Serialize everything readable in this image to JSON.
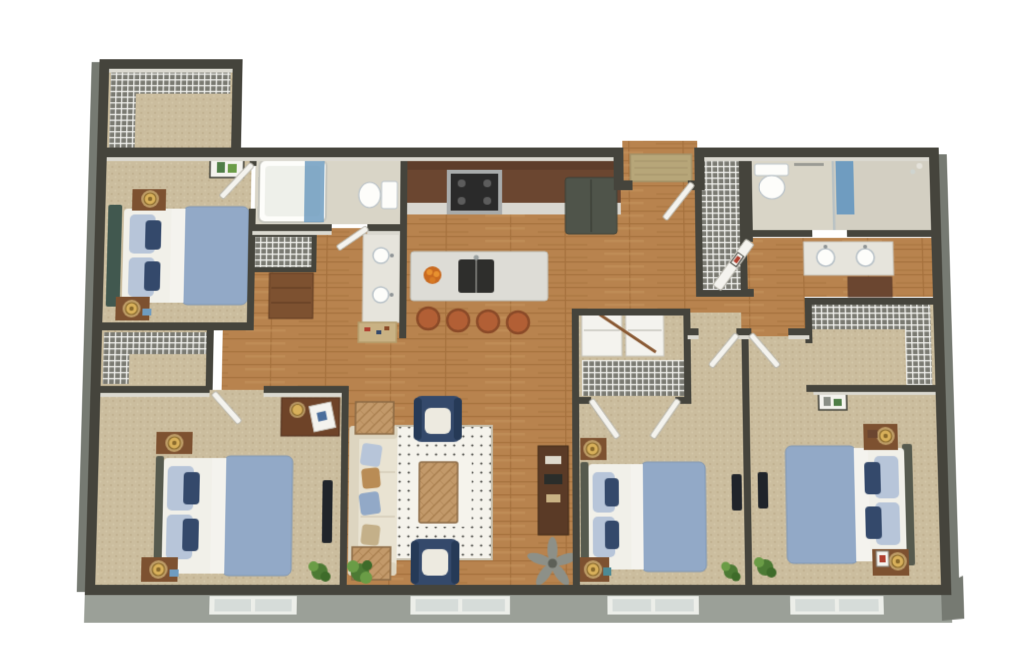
{
  "scene": {
    "label": "3D aerial floor plan rendering of a four-bedroom, two-bathroom apartment with open kitchen and living room",
    "bedrooms": 4,
    "bathrooms": 2,
    "style": "photoreal dollhouse top-down render, no text labels"
  },
  "palette": {
    "bg": "#ffffff",
    "wallTop": "#45443c",
    "wallFace": "#dbd9d0",
    "facade": "#9ba098",
    "facadeDark": "#767a72",
    "wood": "#b8834e",
    "plankLine": "#a5713d",
    "plankLight": "#c9965f",
    "carpet": "#cbbd9e",
    "carpetDotA": "#bcac8a",
    "carpetDotB": "#d6c9ab",
    "bathFloor": "#d9d5c7",
    "wireBase": "#7a7a72",
    "wireLine": "#f2f2ee",
    "white": "#f4f3ee",
    "linen": "#f1f0e9",
    "duvet": "#92a9c7",
    "duvetEdge": "#7e96b4",
    "pillow": "#b7c5d9",
    "navy": "#34496b",
    "headboardTeal": "#41584f",
    "headboardGray": "#565a4e",
    "sofa": "#e9e3d2",
    "sofaArm": "#ddd5c0",
    "rug": "#f5f3ec",
    "rugDot": "#3a3a36",
    "tableWood": "#c2996a",
    "tableLine": "#a97f4f",
    "nightstand": "#7d5130",
    "gold": "#d8b05a",
    "goldDark": "#8a6a2c",
    "glow": "#f4dc96",
    "cabinet": "#6b4630",
    "cabinetDark": "#5e3d2a",
    "counter": "#d9d7d0",
    "island": "#dddcd6",
    "sinkDark": "#2e2e2c",
    "stool": "#b25f35",
    "stoolDark": "#8a4a28",
    "range": "#a8abab",
    "fridge": "#4f544a",
    "tv": "#20242a",
    "plant": "#4c7a34",
    "plantLight": "#6a9c46",
    "plantDark": "#3e6b2a",
    "matEntry": "#b7a679",
    "matHall": "#c9b284",
    "artGreen": "#4e7d46",
    "artRed": "#b04030",
    "windowFrame": "#eceee9",
    "windowPane": "#d6dcd9",
    "towel": "#6f9cc0",
    "porcelain": "#fdfdfa",
    "fixtureStroke": "#b9c2c8"
  },
  "rooms": [
    {
      "id": "entry-closet",
      "label": "walk-in closet with wire shelving",
      "floor": "carpet"
    },
    {
      "id": "bedroom-1",
      "label": "bedroom (top left)",
      "floor": "carpet",
      "furniture": [
        "queen bed with blue duvet",
        "teal headboard",
        "two nightstands with lamps",
        "wall art"
      ]
    },
    {
      "id": "bathroom-1",
      "label": "bathroom (left)",
      "floor": "tile",
      "furniture": [
        "tub shower with blue curtain",
        "toilet",
        "vanity with two sinks",
        "wire linen closet",
        "dresser"
      ]
    },
    {
      "id": "kitchen",
      "label": "kitchen",
      "floor": "wood",
      "furniture": [
        "dark wood cabinets",
        "range",
        "refrigerator",
        "island with sink",
        "fruit bowl",
        "four barstools"
      ]
    },
    {
      "id": "entry",
      "label": "entry alcove with doormat",
      "floor": "wood"
    },
    {
      "id": "pantry",
      "label": "pantry closet with wire shelving",
      "floor": "wood"
    },
    {
      "id": "bathroom-2",
      "label": "bathroom (top right)",
      "floor": "tile",
      "furniture": [
        "toilet",
        "shower with blue towel",
        "double vanity",
        "linen cabinet"
      ]
    },
    {
      "id": "living-room",
      "label": "living room",
      "floor": "wood",
      "furniture": [
        "cream sofa with pillows",
        "two navy armchairs",
        "dotted area rug",
        "herringbone coffee table",
        "two end tables",
        "media console",
        "ceiling fan",
        "plants"
      ]
    },
    {
      "id": "bedroom-2",
      "label": "bedroom (bottom left)",
      "floor": "carpet",
      "furniture": [
        "bed",
        "desk with lamp",
        "tv",
        "wire closet",
        "plant"
      ]
    },
    {
      "id": "bedroom-3",
      "label": "bedroom (bottom center)",
      "floor": "carpet",
      "furniture": [
        "bed",
        "laundry closet with bifold doors",
        "tv",
        "nightstands"
      ]
    },
    {
      "id": "bedroom-4",
      "label": "bedroom (bottom right)",
      "floor": "carpet",
      "furniture": [
        "bed with gray headboard",
        "L-shaped wire closet",
        "nightstands",
        "plant",
        "wall art"
      ]
    }
  ],
  "exterior": {
    "windows": 4,
    "siding": "gray",
    "doormat": "tan"
  }
}
